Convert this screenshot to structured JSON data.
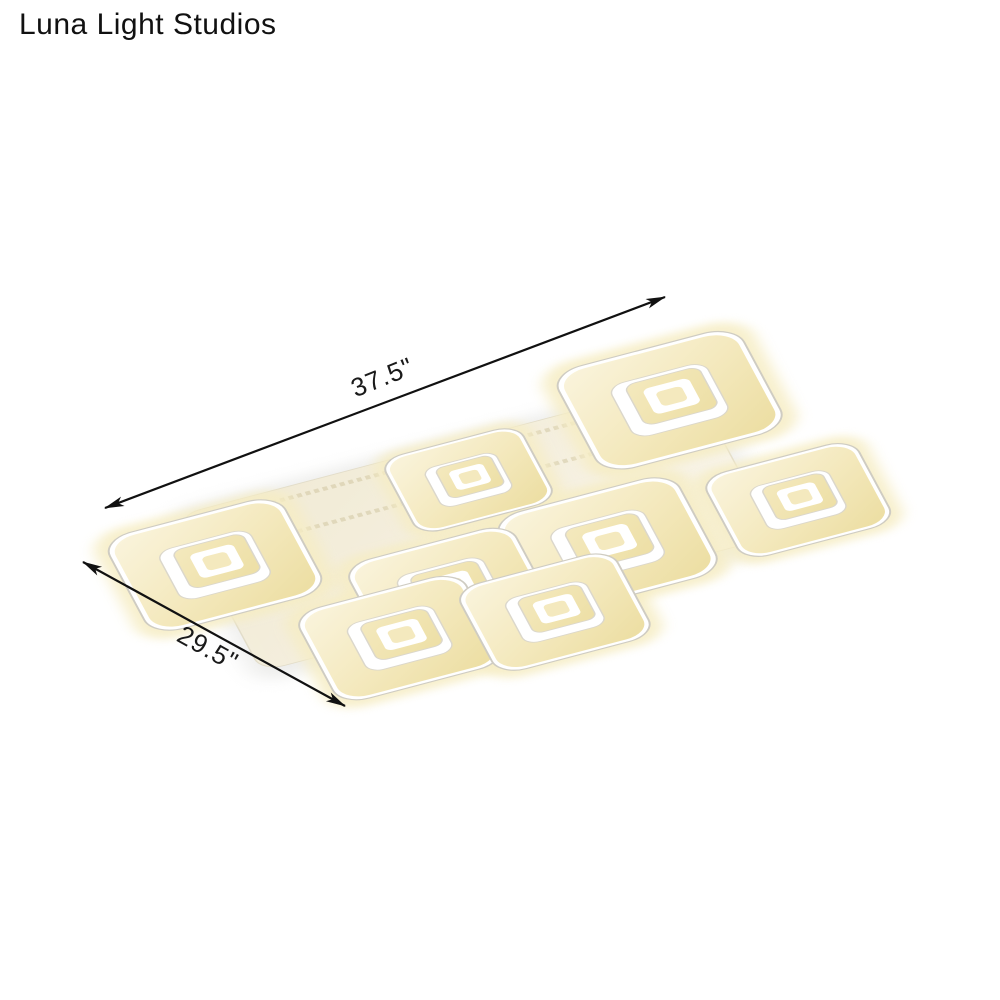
{
  "brand": {
    "name": "Luna Light Studios"
  },
  "dimensions": {
    "length": "37.5\"",
    "width": "29.5\""
  },
  "colors": {
    "background": "#ffffff",
    "text": "#1a1a1a",
    "arrow": "#111111",
    "glow": "#f6edc4",
    "warm_light": "#faf4dd",
    "warm_mid": "#f4e9be",
    "warm_deep": "#eddfa5",
    "rim_white": "#ffffff",
    "outline_gray": "#cfccc2",
    "hole_stroke": "#dbd7cb",
    "plate_cream": "#f1e9d2",
    "plate_light": "#f9f5e8",
    "plate_stroke": "#e2dcc8",
    "plate_band": "#cfc49e",
    "shadow": "#d8d8d4"
  },
  "fixture": {
    "name": "8-light nested-square LED flush mount ceiling light",
    "transform": {
      "u": [
        0.95,
        -0.25
      ],
      "v": [
        0.28,
        0.52
      ],
      "origin": [
        215,
        565
      ]
    },
    "shadow": {
      "x": -20,
      "y": -110,
      "w": 560,
      "h": 330,
      "rx": 28
    },
    "plate": {
      "x": -10,
      "y": -100,
      "w": 540,
      "h": 300,
      "rx": 24
    },
    "bands": [
      {
        "x1": 20,
        "y1": -80,
        "x2": 500,
        "y2": -80
      },
      {
        "x1": 30,
        "y1": -20,
        "x2": 505,
        "y2": -20
      }
    ],
    "modules": [
      {
        "id": "back-right",
        "a": 501,
        "b": -76,
        "s": 195
      },
      {
        "id": "back-middle",
        "a": 276,
        "b": -31,
        "s": 145
      },
      {
        "id": "left",
        "a": 0,
        "b": 0,
        "s": 185
      },
      {
        "id": "center-right",
        "a": 372,
        "b": 140,
        "s": 190
      },
      {
        "id": "center-left",
        "a": 204,
        "b": 146,
        "s": 175
      },
      {
        "id": "right",
        "a": 570,
        "b": 149,
        "s": 160
      },
      {
        "id": "front-left",
        "a": 134,
        "b": 205,
        "s": 175
      },
      {
        "id": "front-middle",
        "a": 290,
        "b": 230,
        "s": 165
      }
    ]
  },
  "annotations": {
    "length_arrow": {
      "x1": 105,
      "y1": 508,
      "x2": 665,
      "y2": 297,
      "label": {
        "x": 383,
        "y": 379,
        "rotate": -22
      }
    },
    "width_arrow": {
      "x1": 83,
      "y1": 562,
      "x2": 345,
      "y2": 706,
      "label": {
        "x": 207,
        "y": 650,
        "rotate": 29
      }
    }
  }
}
